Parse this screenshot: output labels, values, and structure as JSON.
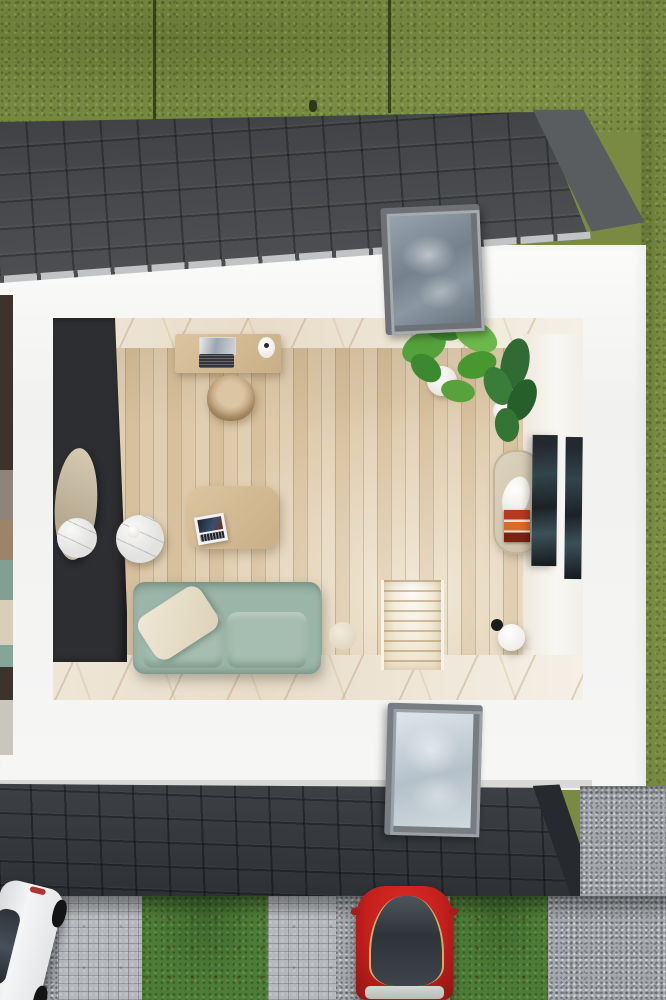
{
  "scene": {
    "title": "top-down cutaway render of a studio living room",
    "exterior": {
      "areas": [
        "hedge-lawn-top",
        "lawn-strip-right",
        "tiled-roof-upper",
        "tiled-roof-lower",
        "white-wall-band",
        "paver-driveway",
        "gravel-path",
        "parking-lawn-strips"
      ],
      "skylights": [
        "skylight-upper",
        "skylight-lower"
      ],
      "vehicles": [
        "white-car-top-view",
        "red-car-top-view"
      ]
    },
    "interior": {
      "room": "open living room with wood plank floor and marble border",
      "furniture": [
        "desk-with-laptop",
        "paper-roll",
        "rattan-desk-chair",
        "monstera-plant-white-pot",
        "fiddle-leaf-fig-white-pot",
        "oval-standing-mirror",
        "marble-tray",
        "round-marble-side-table",
        "white-cup",
        "oak-coffee-table",
        "magazine",
        "sage-green-sofa",
        "cream-lumbar-pillow",
        "cream-ball-pillow",
        "staircase-opening",
        "globe-floor-lamp",
        "capsule-book-shelf",
        "art-frame-large",
        "art-frame-small"
      ]
    }
  },
  "colors": {
    "grass": "#76873f",
    "lawn": "#4e7c37",
    "roofTop": "#46484b",
    "roofBottom": "#33373b",
    "ridgeCap": "#5a5d60",
    "wall": "#f4f4f3",
    "innerWall": "#2d2e31",
    "marble": "#e9ddc9",
    "floorWood": "#dcc7a6",
    "sofa": "#9cb5a9",
    "cushion": "#a6beb1",
    "pillow": "#eae2cf",
    "cobble": "#b4b7bb",
    "gravel": "#a4a8ac",
    "carRed": "#c5201e",
    "carWhite": "#ececed",
    "plantLight": "#55a23c",
    "plantDark": "#2f6b33",
    "frameArt": "#20262b",
    "skyGlassTop": "#7c8894",
    "skyGlassBottom": "#c7d2da"
  }
}
